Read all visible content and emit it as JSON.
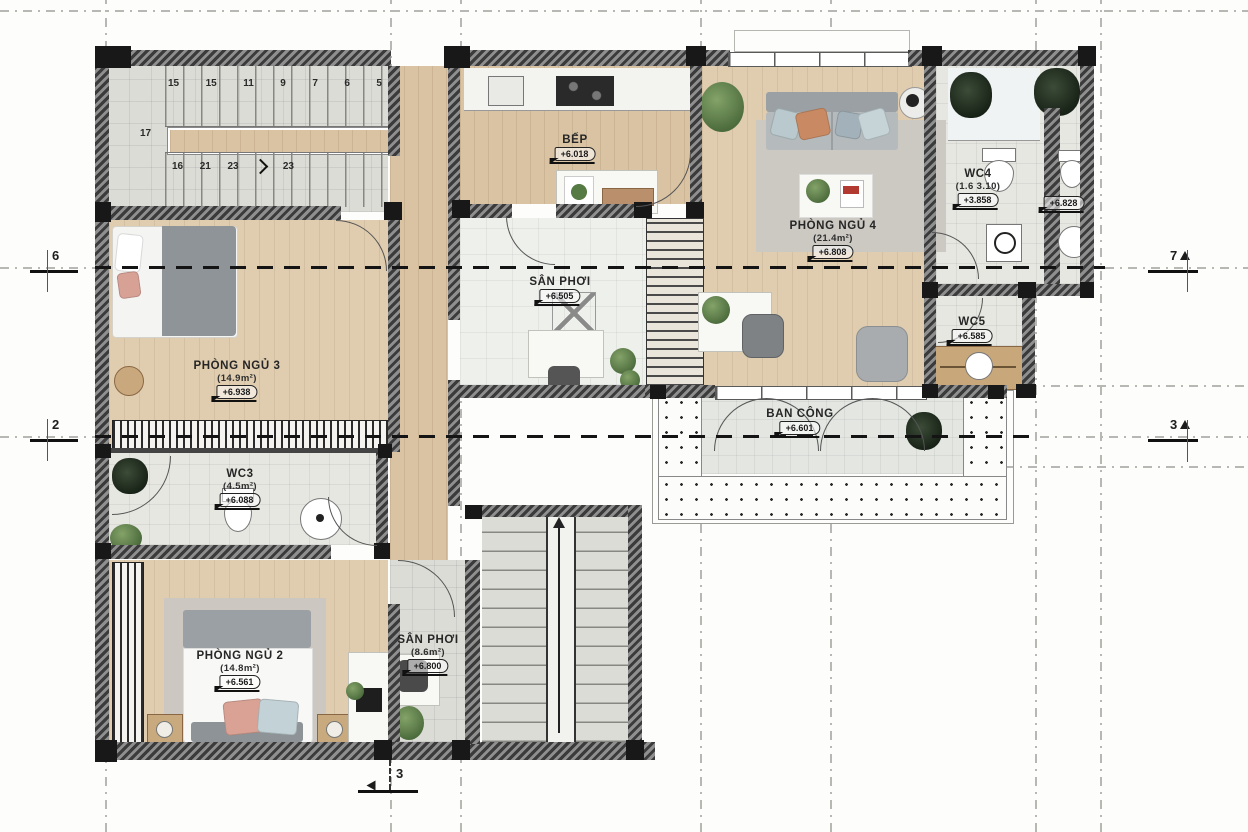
{
  "rooms": {
    "kitchen": {
      "name": "BẾP",
      "tag": "+6.018"
    },
    "bedroom4": {
      "name": "PHÒNG NGỦ 4",
      "area": "(21.4m²)",
      "tag": "+6.808"
    },
    "bedroom3": {
      "name": "PHÒNG NGỦ 3",
      "area": "(14.9m²)",
      "tag": "+6.938"
    },
    "bedroom2": {
      "name": "PHÒNG NGỦ 2",
      "area": "(14.8m²)",
      "tag": "+6.561"
    },
    "wc4": {
      "name": "WC4",
      "area": "(1.6 3.10)",
      "tag": "+3.858"
    },
    "wc4b": {
      "tag": "+6.828"
    },
    "wc5": {
      "name": "WC5",
      "tag": "+6.585"
    },
    "wc3": {
      "name": "WC3",
      "area": "(4.5m²)",
      "tag": "+6.088"
    },
    "san_phoi": {
      "name": "SÂN PHƠI",
      "tag": "+6.505"
    },
    "san_phoi_2": {
      "name": "SÂN PHƠI",
      "area": "(8.6m²)",
      "tag": "+6.800"
    },
    "balcony": {
      "name": "BAN CÔNG",
      "tag": "+6.601"
    }
  },
  "stairs": {
    "upper": [
      "15",
      "15",
      "11",
      "9",
      "7",
      "6",
      "5"
    ],
    "mid": "17",
    "lower": [
      "16",
      "21",
      "23",
      "23"
    ]
  },
  "axes": {
    "left_top": "6",
    "left_bottom": "2",
    "right_top": "7",
    "right_bottom": "3",
    "bottom": "3"
  }
}
